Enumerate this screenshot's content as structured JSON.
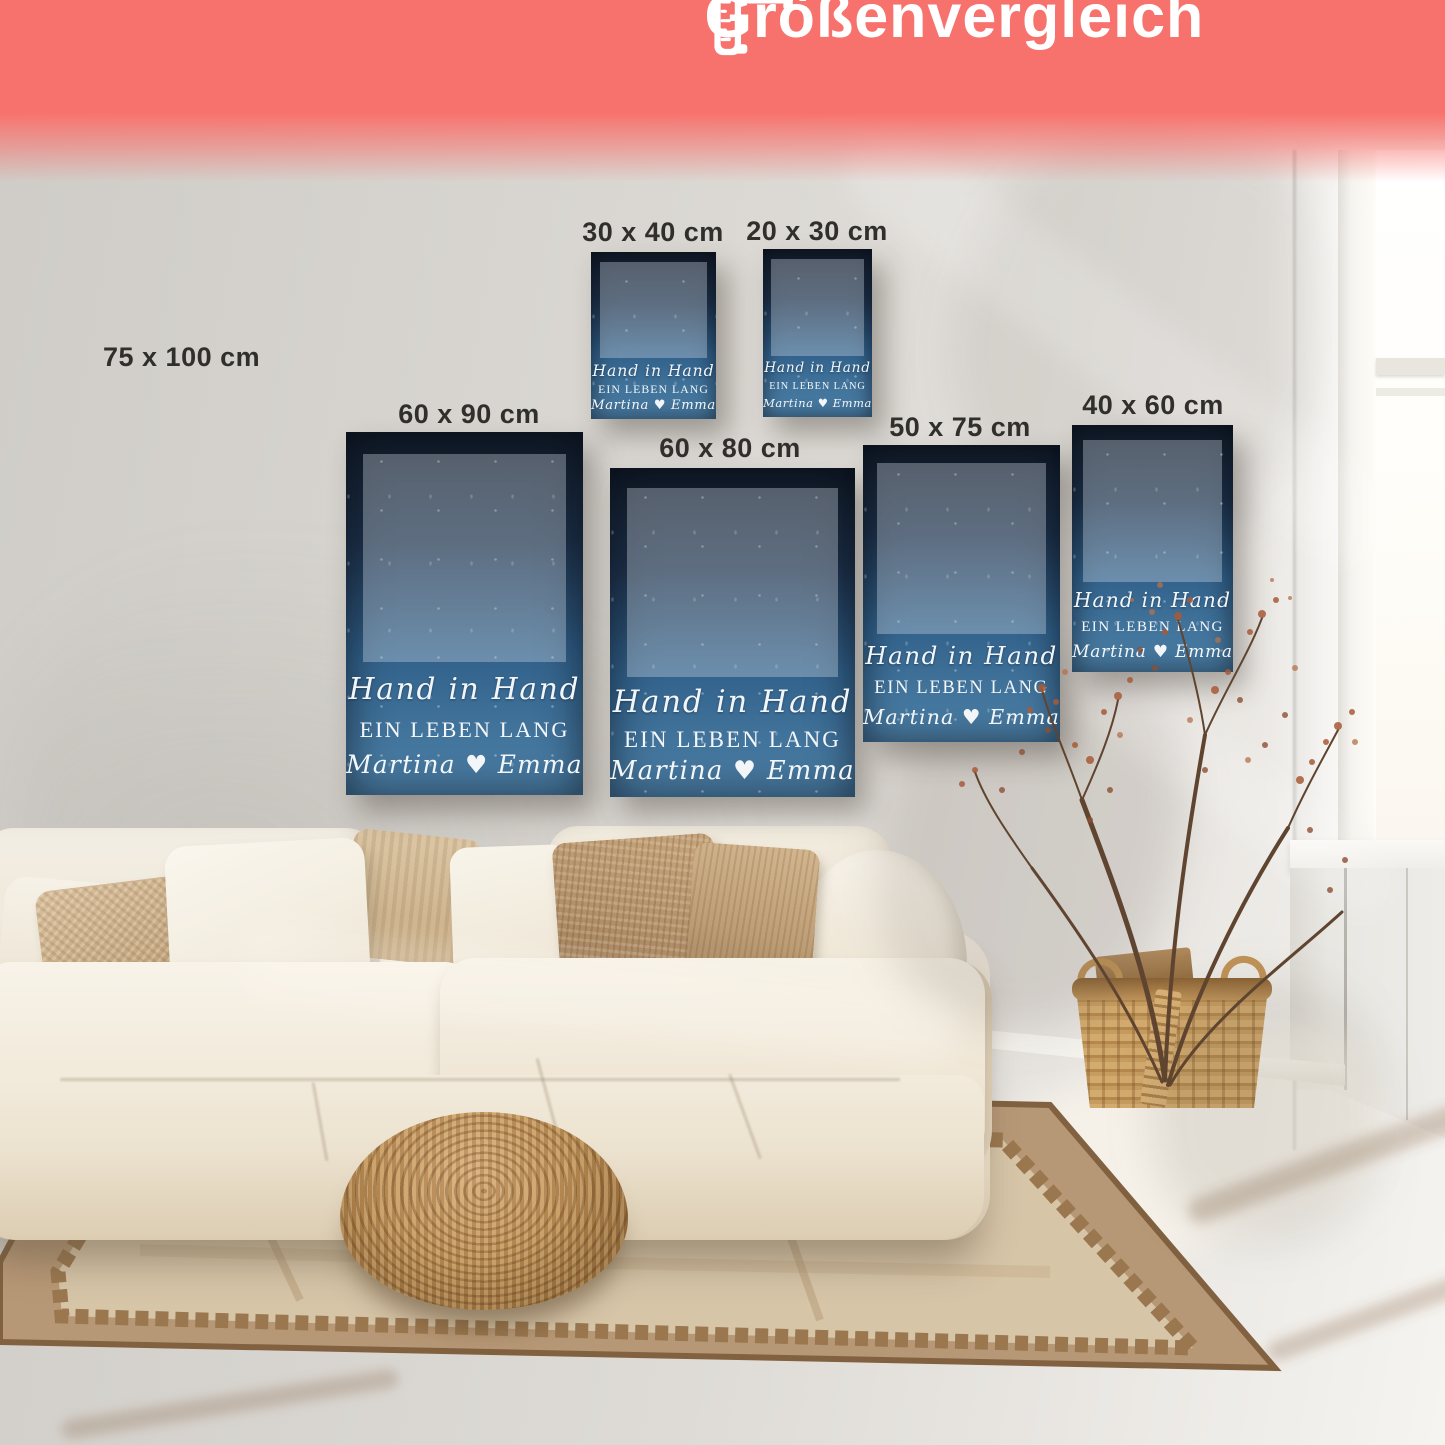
{
  "banner": {
    "title": "Größenvergleich",
    "icon": "ruler-icon"
  },
  "poster_design": {
    "title_script": "Hand in Hand",
    "title_caps": "EIN LEBEN LANG",
    "names": "Martina ♥ Emma"
  },
  "sizes": {
    "s75x100": "75 x 100 cm",
    "s30x40": "30 x 40 cm",
    "s20x30": "20 x 30 cm",
    "s60x90": "60 x 90 cm",
    "s60x80": "60 x 80 cm",
    "s50x75": "50 x 75 cm",
    "s40x60": "40 x 60 cm"
  },
  "colors": {
    "banner": "#f8726d",
    "poster_gradient_top": "#111a27",
    "poster_gradient_bottom": "#4e82a9"
  }
}
